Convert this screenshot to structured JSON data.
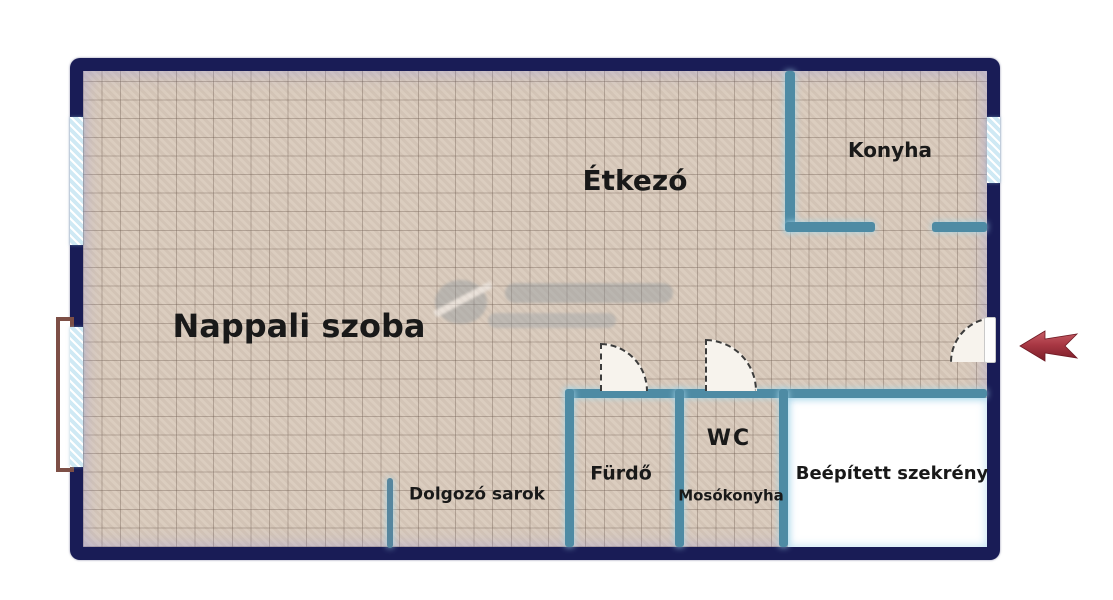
{
  "floorplan": {
    "rooms": [
      {
        "id": "nappali",
        "label": "Nappali szoba"
      },
      {
        "id": "etkezo",
        "label": "Étkezó"
      },
      {
        "id": "konyha",
        "label": "Konyha"
      },
      {
        "id": "dolgozo",
        "label": "Dolgozó sarok"
      },
      {
        "id": "furdo",
        "label": "Fürdő"
      },
      {
        "id": "wc",
        "label": "WC"
      },
      {
        "id": "mosokonyha",
        "label": "Mosókonyha"
      },
      {
        "id": "szekreny",
        "label": "Beépített szekrény"
      }
    ],
    "colors": {
      "outer_wall": "#191c56",
      "inner_wall": "#4e8ba4",
      "floor_tile": "#d8c9ba",
      "window_glazing": "#cfe9f4",
      "balcony_door_frame": "#7d4f46",
      "entry_arrow_dark": "#7a1d28",
      "entry_arrow_light": "#c75e66"
    },
    "icons": {
      "entry_arrow": "left-arrow",
      "watermark": "grey-logo-watermark"
    }
  }
}
